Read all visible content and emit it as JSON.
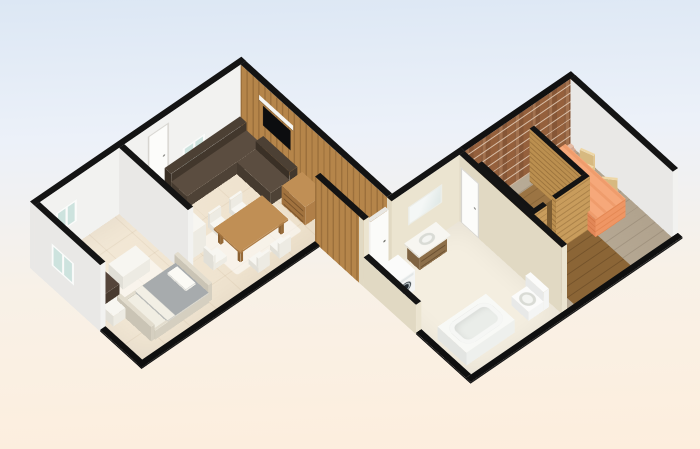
{
  "app": {
    "view": "floorplan-3d-render"
  },
  "canvas": {
    "width": 700,
    "height": 449,
    "bg_top": "#dce7f4",
    "bg_mid": "#ecf1f9",
    "bg_warm": "#f8f1e7",
    "bg_bottom": "#fdeedd"
  },
  "projection": {
    "rotX": 38,
    "rotZ": -41,
    "offsetX": 30,
    "offsetY": 268
  },
  "rooms": [
    "bedroom",
    "living-dining-room",
    "hallway",
    "bathroom",
    "sauna",
    "brick-room"
  ],
  "materials": {
    "white": {
      "top": "#141414",
      "south": "#f2f2f0",
      "west": "#e9e8e6",
      "east": "#f6f6f4",
      "north": "#e5e4e2"
    },
    "beige": {
      "top": "#141414",
      "south": "#ebe4d0",
      "west": "#e1d9c3",
      "east": "#f0e9d6",
      "north": "#e5decb"
    },
    "wood": {
      "top": "#131313",
      "cls": {
        "south": "f-wood",
        "west": "f-wood-dk",
        "east": "f-wood",
        "north": "f-wood"
      }
    },
    "woodh": {
      "top": "#131313",
      "cls": {
        "south": "f-woodh",
        "west": "f-woodh-dk",
        "east": "f-woodh",
        "north": "f-woodh"
      }
    },
    "brick": {
      "top": "#111111",
      "cls": {
        "south": "f-brick",
        "west": "f-brick-dk",
        "east": "f-brick",
        "north": "f-brick"
      }
    },
    "stub": {
      "top": "#0f0f0f",
      "south": "#1d1d1d",
      "west": "#161616",
      "east": "#1d1d1d",
      "north": "#1d1d1d"
    },
    "whiteDoor": {
      "top": "#e8e7e3",
      "south": "#fbfbf9",
      "west": "#f0efec",
      "east": "#f6f5f2",
      "north": "#f3f2ef"
    },
    "whiteBox": {
      "top": "#f7f6f1",
      "south": "#edebe3",
      "west": "#e1dfd7",
      "east": "#f1efe8",
      "north": "#e9e7df"
    },
    "washer": {
      "top": "#fbfbfa",
      "south": "#f4f5f4",
      "west": "#e8e9e8",
      "east": "#f1f2f1",
      "north": "#eff0ef"
    },
    "metal": {
      "top": "#e2dccd",
      "south": "#d5cfc0",
      "west": "#cac4b5",
      "east": "#dad4c5",
      "north": "#d0cabb"
    },
    "bedBase": {
      "top": "#f1eee3",
      "south": "#e8e4d8",
      "west": "#dedacd",
      "east": "#ece8dc",
      "north": "#e4e0d4"
    },
    "blanket": {
      "top": "#a7abad",
      "south": "#c8cac8",
      "west": "#babcb9",
      "east": "#c2c4c1",
      "north": "#bfc1be"
    },
    "pillow": {
      "top": "#fbfaf5",
      "south": "#f0efe9",
      "west": "#e6e5df",
      "east": "#f3f2ec",
      "north": "#edece6"
    },
    "armchair": {
      "top": "#463830",
      "south": "#3c2f28",
      "west": "#352a23",
      "east": "#42352d",
      "north": "#3c2f28"
    },
    "armchairSeat": {
      "top": "#55453a",
      "south": "#483a2f",
      "west": "#3f332a",
      "east": "#504237",
      "north": "#483a2f"
    },
    "sofa": {
      "top": "#5b4d40",
      "south": "#4e4236",
      "west": "#453a2f",
      "east": "#564a3d",
      "north": "#4e4236"
    },
    "sofaDark": {
      "top": "#4c4034",
      "south": "#42372c",
      "west": "#3a3026",
      "east": "#473c31",
      "north": "#42372c"
    },
    "woodFurn": {
      "top": "#c08f55",
      "south": "#b07f48",
      "west": "#a1723e",
      "east": "#b98849",
      "north": "#b07f48"
    },
    "woodLeg": {
      "top": "#a3753f",
      "south": "#966a38",
      "west": "#8a6032",
      "east": "#9c7040",
      "north": "#966a38"
    },
    "vanity": {
      "top": "#9a7a52",
      "south": "#8d6f49",
      "west": "#7f6341",
      "east": "#947450",
      "north": "#8d6f49"
    },
    "tubMat": {
      "top": "#f8f9f6",
      "south": "#eef0ed",
      "west": "#e3e5e2",
      "east": "#f2f4f1",
      "north": "#eef0ed"
    },
    "darkwood": {
      "top": "#7c5c31",
      "south": "#6e4f28",
      "west": "#624622",
      "east": "#755527",
      "north": "#6e4f28"
    },
    "orange": {
      "top": "#f6a87a",
      "cls": {
        "top": "f-orangetop",
        "south": "f-orange",
        "west": "f-orange-dk",
        "east": "f-orange",
        "north": "f-orange"
      }
    },
    "tan": {
      "top": "#eed7a6",
      "south": "#e2c58e",
      "west": "#d7b980",
      "east": "#e8cd98",
      "north": "#e2c58e"
    },
    "figure": {
      "top": "#d9b09a",
      "south": "#c79e88",
      "west": "#b98f7a",
      "east": "#d0a691",
      "north": "#c79e88"
    },
    "figureHead": {
      "top": "#e4bca6",
      "south": "#d4a892",
      "west": "#c79a84",
      "east": "#dcb09a",
      "north": "#d4a892"
    }
  },
  "items": [
    {
      "n": "floor-left-wing",
      "k": "floor",
      "cls": "f-tile",
      "x": 4,
      "y": 4,
      "w": 272,
      "d": 166,
      "z": 0.4,
      "dec": [
        {
          "f": "top",
          "x": 146,
          "t": 81,
          "w": 86,
          "h": 58,
          "c": "d-rug"
        },
        {
          "f": "top",
          "x": 24,
          "t": 51,
          "w": 70,
          "h": 50,
          "c": "d-rug"
        }
      ]
    },
    {
      "n": "floor-hallway",
      "k": "floor",
      "cls": "f-corr",
      "x": 243,
      "y": 163,
      "w": 30,
      "d": 74,
      "z": 0.4
    },
    {
      "n": "floor-bathroom",
      "k": "floor",
      "cls": "f-pale",
      "x": 243,
      "y": 237,
      "w": 120,
      "d": 156,
      "z": 0.4
    },
    {
      "n": "floor-brick-room",
      "k": "floor",
      "cls": "f-plankgray",
      "x": 370,
      "y": 237,
      "w": 140,
      "d": 156,
      "z": 0.4
    },
    {
      "n": "floor-sauna",
      "k": "floor",
      "cls": "f-woodfloor",
      "x": 386,
      "y": 251,
      "w": 63,
      "d": 73,
      "z": 1.2
    },
    {
      "n": "floor-sauna-porch",
      "k": "floor",
      "cls": "f-woodfloor2",
      "x": 380,
      "y": 330,
      "w": 75,
      "d": 63,
      "z": 0.8
    },
    {
      "n": "wall-north",
      "k": "wall",
      "m": "white",
      "x": 0,
      "y": 0,
      "w": 280,
      "d": 7,
      "h": 108,
      "dec": [
        {
          "f": "south",
          "x": 28,
          "t": 36,
          "w": 28,
          "h": 36,
          "c": "d-window"
        },
        {
          "f": "south",
          "x": 150,
          "t": 14,
          "w": 28,
          "h": 94,
          "c": "d-door"
        },
        {
          "f": "south",
          "x": 196,
          "t": 36,
          "w": 30,
          "h": 36,
          "c": "d-window"
        }
      ]
    },
    {
      "n": "wall-bedroom-west",
      "k": "wall",
      "m": "white",
      "x": 0,
      "y": 7,
      "w": 7,
      "d": 100,
      "h": 108,
      "dec": [
        {
          "f": "west",
          "x": 26,
          "t": 36,
          "w": 34,
          "h": 36,
          "c": "d-window"
        }
      ]
    },
    {
      "n": "wall-bedroom-west-cut",
      "k": "wall",
      "m": "stub",
      "x": 0,
      "y": 107,
      "w": 7,
      "d": 63,
      "h": 3
    },
    {
      "n": "wall-living-east-wood",
      "k": "wall",
      "m": "wood",
      "x": 273,
      "y": 7,
      "w": 7,
      "d": 223,
      "h": 108,
      "dec": [
        {
          "f": "west",
          "x": 28,
          "t": 22,
          "w": 52,
          "h": 8,
          "c": "d-shelf"
        },
        {
          "f": "west",
          "x": 34,
          "t": 34,
          "w": 42,
          "h": 32,
          "c": "d-tv"
        }
      ]
    },
    {
      "n": "wall-partition",
      "k": "wall",
      "m": "white",
      "x": 112,
      "y": 7,
      "w": 7,
      "d": 105,
      "h": 108
    },
    {
      "n": "wall-left-south-cut",
      "k": "wall",
      "m": "stub",
      "x": 0,
      "y": 163,
      "w": 236,
      "d": 7,
      "h": 3
    },
    {
      "n": "wall-hallway-west",
      "k": "wall",
      "m": "wood",
      "x": 236,
      "y": 163,
      "w": 7,
      "d": 67,
      "h": 108
    },
    {
      "n": "wall-bath-north-pier",
      "k": "wall",
      "m": "beige",
      "x": 236,
      "y": 230,
      "w": 7,
      "d": 7,
      "h": 108
    },
    {
      "n": "door-bathroom-north",
      "k": "wall",
      "m": "whiteDoor",
      "x": 246,
      "y": 231,
      "w": 24,
      "d": 5,
      "h": 96,
      "dec": [
        {
          "f": "south",
          "x": 17,
          "t": 45,
          "w": 3,
          "h": 3,
          "c": "d-dot"
        }
      ]
    },
    {
      "n": "wall-bath-north",
      "k": "wall",
      "m": "beige",
      "x": 273,
      "y": 230,
      "w": 97,
      "d": 7,
      "h": 108,
      "dec": [
        {
          "f": "south",
          "x": 22,
          "t": 28,
          "w": 45,
          "h": 30,
          "c": "d-mirror"
        }
      ]
    },
    {
      "n": "wall-brick-north",
      "k": "wall",
      "m": "brick",
      "x": 370,
      "y": 230,
      "w": 147,
      "d": 7,
      "h": 108
    },
    {
      "n": "wall-brickroom-east",
      "k": "wall",
      "m": "white",
      "x": 510,
      "y": 237,
      "w": 7,
      "d": 156,
      "h": 108
    },
    {
      "n": "wall-bath-west",
      "k": "wall",
      "m": "beige",
      "x": 236,
      "y": 237,
      "w": 7,
      "d": 80,
      "h": 48
    },
    {
      "n": "wall-bath-west-cut",
      "k": "wall",
      "m": "stub",
      "x": 236,
      "y": 317,
      "w": 7,
      "d": 76,
      "h": 3
    },
    {
      "n": "wall-bath-east",
      "k": "wall",
      "m": "beige",
      "x": 363,
      "y": 237,
      "w": 7,
      "d": 156,
      "h": 108,
      "dec": [
        {
          "f": "west",
          "x": 2,
          "t": 18,
          "w": 28,
          "h": 90,
          "c": "d-door"
        }
      ]
    },
    {
      "n": "wall-right-south-cut",
      "k": "wall",
      "m": "stub",
      "x": 236,
      "y": 393,
      "w": 281,
      "d": 7,
      "h": 3
    },
    {
      "n": "wall-sauna-west",
      "k": "wall",
      "m": "woodh",
      "x": 380,
      "y": 245,
      "w": 6,
      "d": 79,
      "h": 86
    },
    {
      "n": "wall-sauna-south-a",
      "k": "wall",
      "m": "woodh",
      "x": 380,
      "y": 324,
      "w": 18,
      "d": 6,
      "h": 86
    },
    {
      "n": "wall-sauna-south-b",
      "k": "wall",
      "m": "woodh",
      "x": 410,
      "y": 324,
      "w": 45,
      "d": 6,
      "h": 86
    },
    {
      "n": "wall-sauna-east",
      "k": "wall",
      "m": "woodh",
      "x": 449,
      "y": 245,
      "w": 6,
      "d": 79,
      "h": 86
    },
    {
      "n": "armchair-back",
      "k": "box",
      "m": "armchair",
      "x": 14,
      "y": 56,
      "w": 8,
      "d": 30,
      "h": 34
    },
    {
      "n": "armchair-seat",
      "k": "box",
      "m": "armchairSeat",
      "x": 22,
      "y": 56,
      "w": 22,
      "d": 30,
      "h": 20
    },
    {
      "n": "desk",
      "k": "box",
      "m": "whiteBox",
      "x": 52,
      "y": 60,
      "w": 36,
      "d": 22,
      "h": 21
    },
    {
      "n": "nightstand",
      "k": "box",
      "m": "whiteBox",
      "x": 14,
      "y": 94,
      "w": 20,
      "d": 17,
      "h": 17
    },
    {
      "n": "bed-footboard",
      "k": "box",
      "m": "metal",
      "x": 30,
      "y": 98,
      "w": 5,
      "d": 52,
      "h": 24
    },
    {
      "n": "bed-headboard",
      "k": "box",
      "m": "metal",
      "x": 106,
      "y": 98,
      "w": 5,
      "d": 52,
      "h": 28
    },
    {
      "n": "bed-rail-north",
      "k": "box",
      "m": "metal",
      "x": 35,
      "y": 99,
      "w": 71,
      "d": 3,
      "h": 15
    },
    {
      "n": "bed-rail-south",
      "k": "box",
      "m": "metal",
      "x": 35,
      "y": 148,
      "w": 71,
      "d": 3,
      "h": 15
    },
    {
      "n": "bed-mattress",
      "k": "box",
      "m": "bedBase",
      "x": 36,
      "y": 100,
      "w": 70,
      "d": 50,
      "h": 13
    },
    {
      "n": "bed-blanket",
      "k": "box",
      "m": "blanket",
      "x": 52,
      "y": 100,
      "w": 54,
      "d": 50,
      "h": 16,
      "dec": [
        {
          "f": "top",
          "x": 0,
          "t": 0,
          "w": 10,
          "h": 50,
          "c": "d-sheet"
        }
      ]
    },
    {
      "n": "bed-pillow",
      "k": "box",
      "m": "pillow",
      "x": 90,
      "y": 106,
      "w": 13,
      "d": 28,
      "h": 19
    },
    {
      "n": "kitchen-counter",
      "k": "box",
      "m": "whiteBox",
      "x": 122,
      "y": 10,
      "w": 26,
      "d": 60,
      "h": 26
    },
    {
      "n": "kitchen-tall-unit",
      "k": "box",
      "m": "whiteBox",
      "x": 122,
      "y": 70,
      "w": 26,
      "d": 28,
      "h": 42
    },
    {
      "n": "sofa-back-north",
      "k": "box",
      "m": "sofaDark",
      "x": 168,
      "y": 12,
      "w": 100,
      "d": 10,
      "h": 33
    },
    {
      "n": "sofa-seat-north",
      "k": "box",
      "m": "sofa",
      "x": 168,
      "y": 22,
      "w": 100,
      "d": 24,
      "h": 20
    },
    {
      "n": "sofa-back-east",
      "k": "box",
      "m": "sofaDark",
      "x": 259,
      "y": 46,
      "w": 10,
      "d": 52,
      "h": 33
    },
    {
      "n": "sofa-seat-east",
      "k": "box",
      "m": "sofa",
      "x": 234,
      "y": 46,
      "w": 25,
      "d": 52,
      "h": 20
    },
    {
      "n": "dresser",
      "k": "box",
      "m": "woodFurn",
      "x": 243,
      "y": 104,
      "w": 27,
      "d": 36,
      "h": 30,
      "dec": [
        {
          "f": "west",
          "x": 3,
          "t": 4,
          "w": 30,
          "h": 24,
          "c": "d-drawers"
        }
      ]
    },
    {
      "n": "dining-table-top",
      "k": "box",
      "m": "woodFurn",
      "x": 160,
      "y": 96,
      "w": 64,
      "d": 40,
      "z": 20,
      "h": 3
    },
    {
      "n": "table-leg-1",
      "k": "box",
      "m": "woodLeg",
      "x": 163,
      "y": 99,
      "w": 4,
      "d": 4,
      "h": 20
    },
    {
      "n": "table-leg-2",
      "k": "box",
      "m": "woodLeg",
      "x": 217,
      "y": 99,
      "w": 4,
      "d": 4,
      "h": 20
    },
    {
      "n": "table-leg-3",
      "k": "box",
      "m": "woodLeg",
      "x": 163,
      "y": 129,
      "w": 4,
      "d": 4,
      "h": 20
    },
    {
      "n": "table-leg-4",
      "k": "box",
      "m": "woodLeg",
      "x": 217,
      "y": 129,
      "w": 4,
      "d": 4,
      "h": 20
    },
    {
      "n": "chair-n1-back",
      "k": "box",
      "m": "whiteBox",
      "x": 168,
      "y": 78,
      "w": 15,
      "d": 3,
      "h": 24
    },
    {
      "n": "chair-n1-seat",
      "k": "box",
      "m": "whiteBox",
      "x": 168,
      "y": 81,
      "w": 15,
      "d": 15,
      "h": 9
    },
    {
      "n": "chair-n2-back",
      "k": "box",
      "m": "whiteBox",
      "x": 196,
      "y": 78,
      "w": 15,
      "d": 3,
      "h": 24
    },
    {
      "n": "chair-n2-seat",
      "k": "box",
      "m": "whiteBox",
      "x": 196,
      "y": 81,
      "w": 15,
      "d": 15,
      "h": 9
    },
    {
      "n": "chair-s1-seat",
      "k": "box",
      "m": "whiteBox",
      "x": 168,
      "y": 140,
      "w": 15,
      "d": 15,
      "h": 9
    },
    {
      "n": "chair-s1-back",
      "k": "box",
      "m": "whiteBox",
      "x": 168,
      "y": 152,
      "w": 15,
      "d": 3,
      "h": 24
    },
    {
      "n": "chair-s2-seat",
      "k": "box",
      "m": "whiteBox",
      "x": 196,
      "y": 140,
      "w": 15,
      "d": 15,
      "h": 9
    },
    {
      "n": "chair-s2-back",
      "k": "box",
      "m": "whiteBox",
      "x": 196,
      "y": 152,
      "w": 15,
      "d": 3,
      "h": 24
    },
    {
      "n": "chair-w-back",
      "k": "box",
      "m": "whiteBox",
      "x": 136,
      "y": 108,
      "w": 3,
      "d": 15,
      "h": 24
    },
    {
      "n": "chair-w-seat",
      "k": "box",
      "m": "whiteBox",
      "x": 139,
      "y": 108,
      "w": 15,
      "d": 15,
      "h": 9
    },
    {
      "n": "washing-machine",
      "k": "box",
      "m": "washer",
      "x": 246,
      "y": 248,
      "w": 26,
      "d": 26,
      "h": 33,
      "dec": [
        {
          "f": "south",
          "x": 2,
          "t": 2,
          "w": 22,
          "h": 4,
          "c": "d-wpanel"
        },
        {
          "f": "south",
          "x": 4,
          "t": 9,
          "w": 18,
          "h": 18,
          "c": "d-wdoor"
        }
      ]
    },
    {
      "n": "vanity-cabinet",
      "k": "box",
      "m": "vanity",
      "x": 292,
      "y": 239,
      "w": 36,
      "d": 19,
      "h": 24,
      "dec": [
        {
          "f": "south",
          "x": 2,
          "t": 3,
          "w": 32,
          "h": 18,
          "c": "d-drawers"
        }
      ]
    },
    {
      "n": "vanity-top",
      "k": "box",
      "m": "whiteBox",
      "x": 289,
      "y": 238,
      "w": 42,
      "d": 22,
      "z": 24,
      "h": 3,
      "dec": [
        {
          "f": "top",
          "x": 12,
          "t": 4,
          "w": 18,
          "h": 13,
          "c": "d-bowl"
        }
      ]
    },
    {
      "n": "bathtub",
      "k": "box",
      "m": "tubMat",
      "x": 248,
      "y": 336,
      "w": 64,
      "d": 44,
      "h": 21,
      "dec": [
        {
          "f": "top",
          "x": 5,
          "t": 5,
          "w": 54,
          "h": 34,
          "c": "d-tub"
        }
      ]
    },
    {
      "n": "toilet-base",
      "k": "box",
      "m": "washer",
      "x": 332,
      "y": 352,
      "w": 20,
      "d": 26,
      "h": 15,
      "dec": [
        {
          "f": "top",
          "x": 2,
          "t": 4,
          "w": 16,
          "h": 18,
          "c": "d-bowl"
        }
      ]
    },
    {
      "n": "toilet-tank",
      "k": "box",
      "m": "washer",
      "x": 352,
      "y": 350,
      "w": 7,
      "d": 28,
      "h": 30
    },
    {
      "n": "sauna-bench",
      "k": "box",
      "m": "darkwood",
      "x": 413,
      "y": 287,
      "w": 32,
      "d": 33,
      "h": 17
    },
    {
      "n": "orange-bed",
      "k": "box",
      "m": "orange",
      "x": 452,
      "y": 250,
      "w": 40,
      "d": 92,
      "h": 30
    },
    {
      "n": "tan-chair-a-seat",
      "k": "box",
      "m": "tan",
      "x": 490,
      "y": 264,
      "w": 16,
      "d": 16,
      "h": 9,
      "rot": -20,
      "p": [
        498,
        272
      ]
    },
    {
      "n": "tan-chair-a-back",
      "k": "box",
      "m": "tan",
      "x": 503,
      "y": 264,
      "w": 3,
      "d": 16,
      "h": 26,
      "rot": -20,
      "p": [
        498,
        272
      ]
    },
    {
      "n": "tan-chair-b-seat",
      "k": "box",
      "m": "tan",
      "x": 486,
      "y": 306,
      "w": 16,
      "d": 16,
      "h": 9,
      "rot": -42,
      "p": [
        494,
        314
      ]
    },
    {
      "n": "tan-chair-b-back",
      "k": "box",
      "m": "tan",
      "x": 499,
      "y": 306,
      "w": 3,
      "d": 16,
      "h": 26,
      "rot": -42,
      "p": [
        494,
        314
      ]
    },
    {
      "n": "figurine-body",
      "k": "box",
      "m": "figure",
      "x": 496,
      "y": 246,
      "w": 7,
      "d": 7,
      "h": 15
    },
    {
      "n": "figurine-head",
      "k": "box",
      "m": "figureHead",
      "x": 497,
      "y": 247,
      "w": 5,
      "d": 5,
      "z": 15,
      "h": 5
    }
  ]
}
